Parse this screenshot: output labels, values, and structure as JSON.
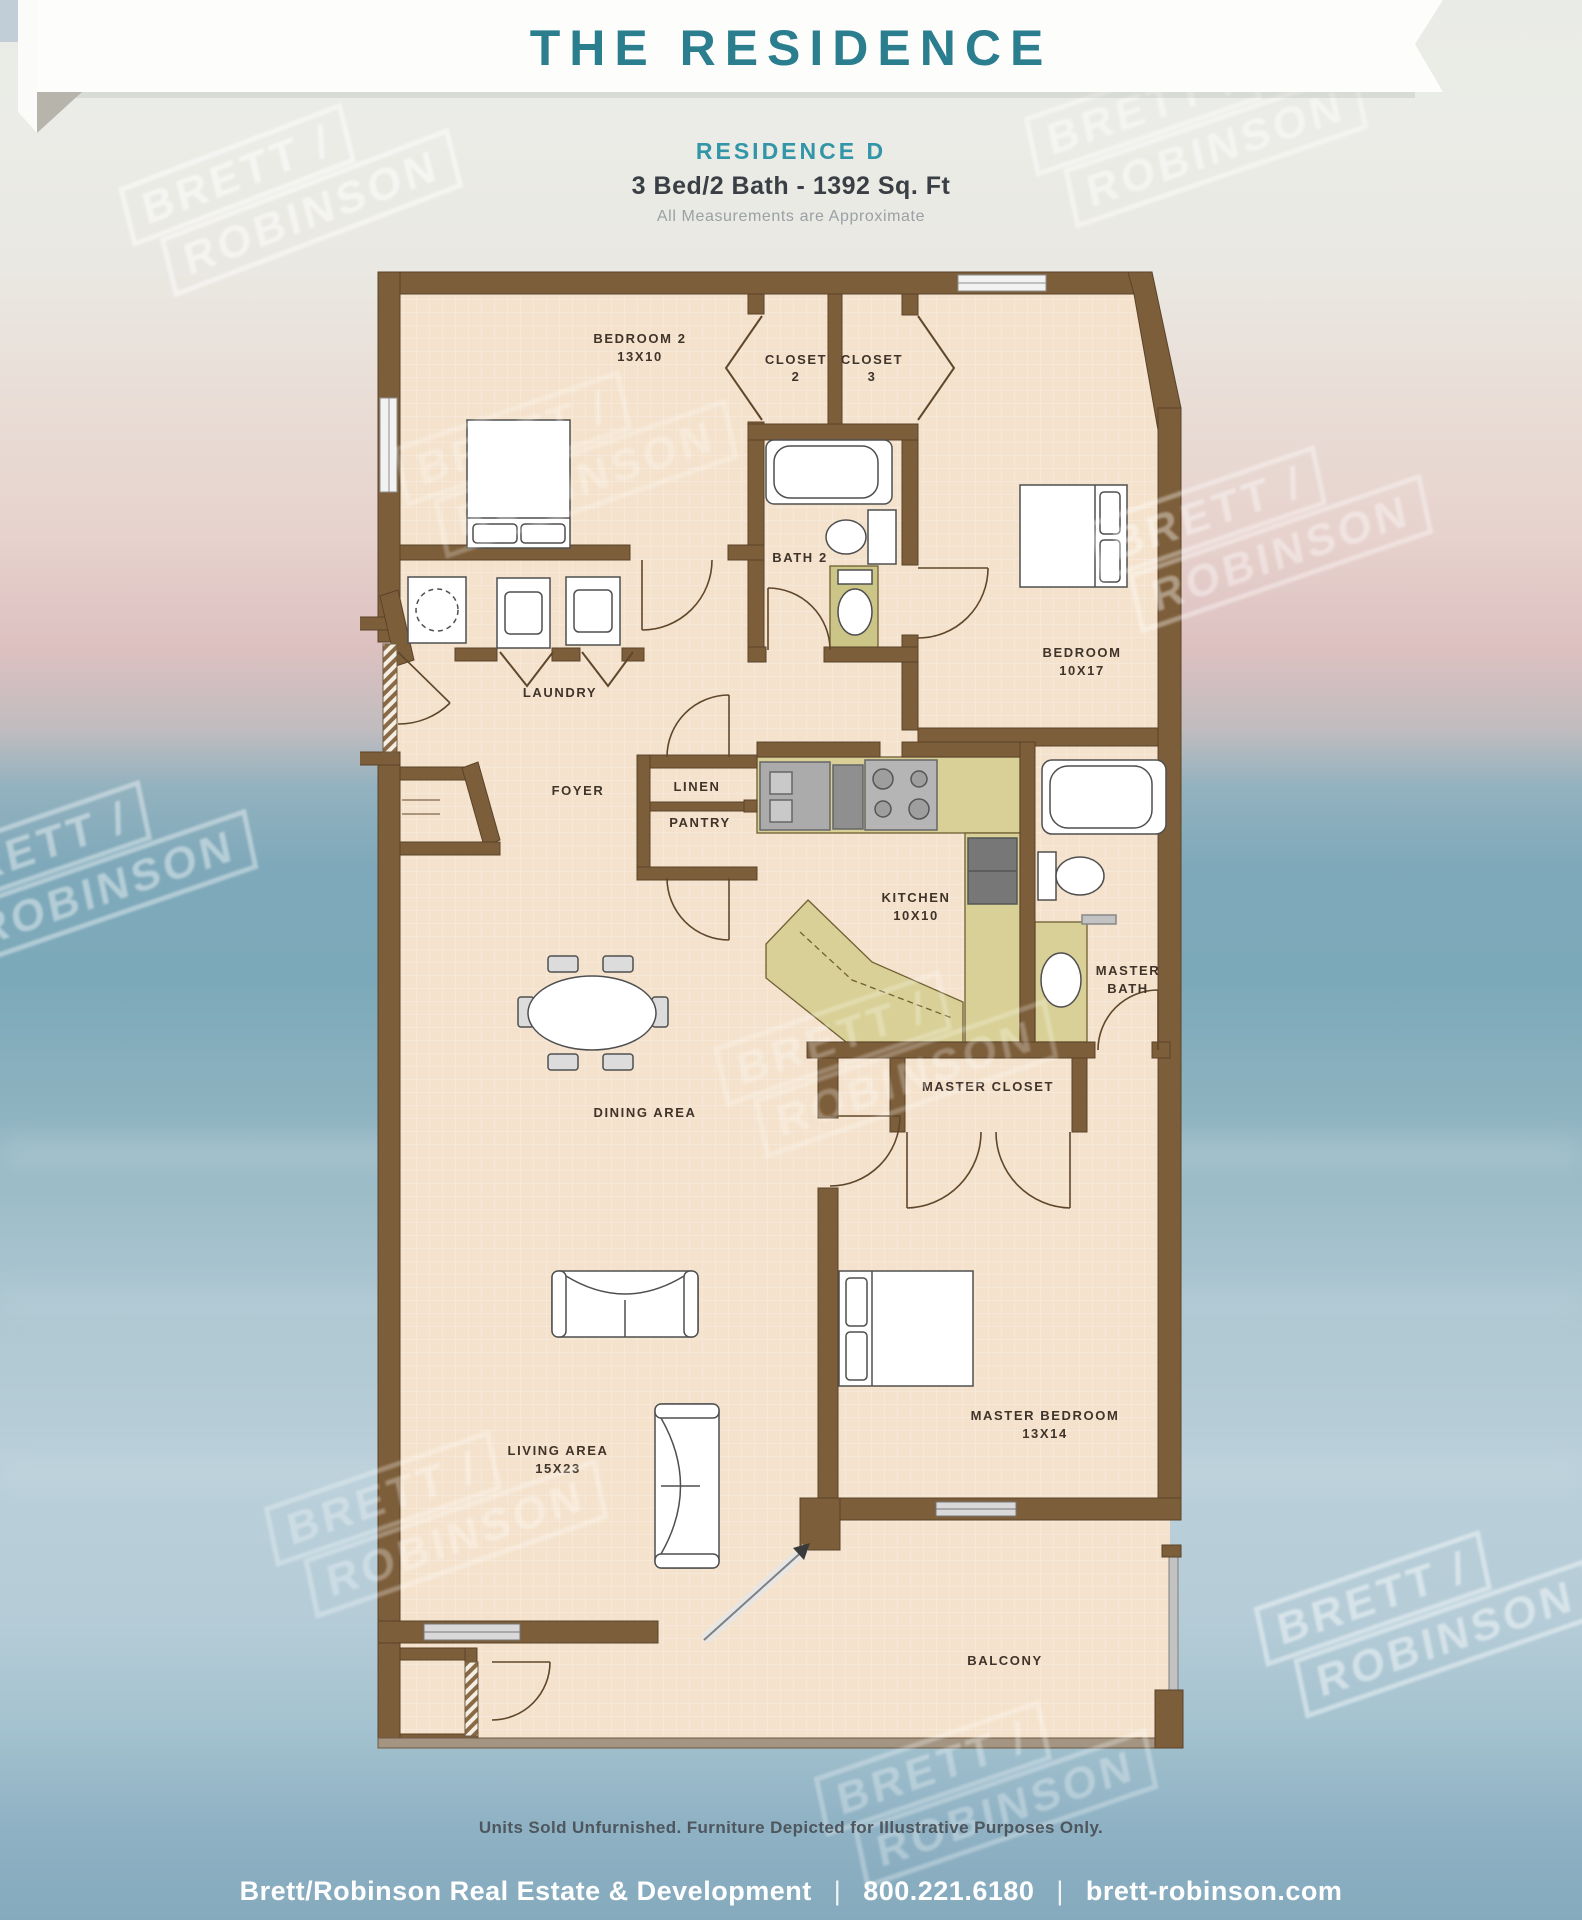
{
  "header": {
    "banner_title": "THE RESIDENCE"
  },
  "subtitle": {
    "residence": "RESIDENCE D",
    "specs": "3 Bed/2 Bath - 1392 Sq. Ft",
    "note": "All Measurements are Approximate"
  },
  "watermark": {
    "line1": "BRETT /",
    "line2": "ROBINSON"
  },
  "floorplan": {
    "rooms": {
      "bedroom2": {
        "name": "BEDROOM 2",
        "dims": "13X10"
      },
      "closet2": {
        "line1": "CLOSET",
        "line2": "2"
      },
      "closet3": {
        "line1": "CLOSET",
        "line2": "3"
      },
      "bath2": {
        "name": "BATH 2"
      },
      "bedroom": {
        "name": "BEDROOM",
        "dims": "10X17"
      },
      "laundry": {
        "name": "LAUNDRY"
      },
      "foyer": {
        "name": "FOYER"
      },
      "linen": {
        "name": "LINEN"
      },
      "pantry": {
        "name": "PANTRY"
      },
      "kitchen": {
        "name": "KITCHEN",
        "dims": "10X10"
      },
      "master_bath": {
        "line1": "MASTER",
        "line2": "BATH"
      },
      "master_closet": {
        "name": "MASTER CLOSET"
      },
      "dining": {
        "name": "DINING AREA"
      },
      "living": {
        "name": "LIVING AREA",
        "dims": "15X23"
      },
      "master_bedroom": {
        "name": "MASTER BEDROOM",
        "dims": "13X14"
      },
      "balcony": {
        "name": "BALCONY"
      }
    }
  },
  "footer": {
    "disclaimer": "Units Sold Unfurnished. Furniture Depicted for Illustrative Purposes Only.",
    "company": "Brett/Robinson Real Estate & Development",
    "phone": "800.221.6180",
    "website": "brett-robinson.com",
    "separator": "|"
  },
  "colors": {
    "accent_teal": "#2b7e8e",
    "wall_brown": "#7d5e3a",
    "floor_tan": "#f4e2cc",
    "counter_olive": "#d8d096",
    "ocean_blue": "#7fa9ba"
  }
}
